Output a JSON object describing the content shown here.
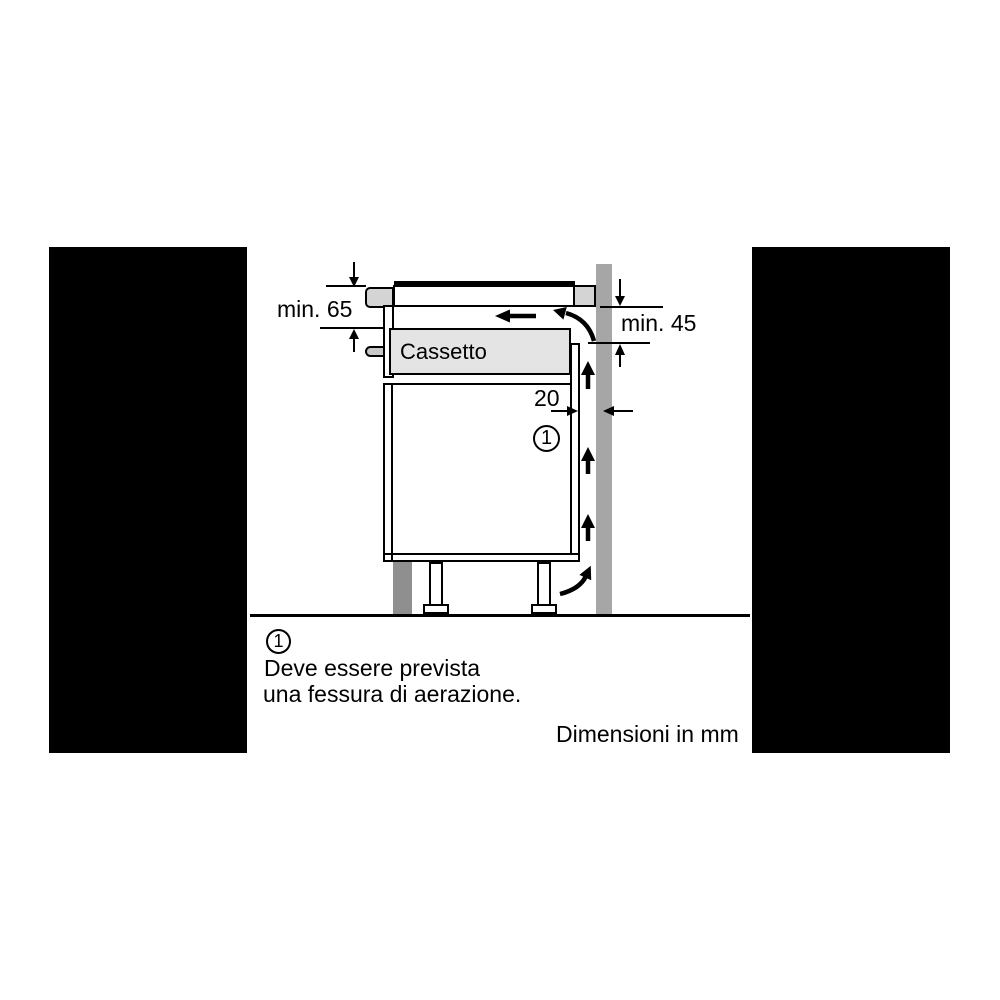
{
  "diagram": {
    "drawer_label": "Cassetto",
    "dimensions": {
      "worktop_depth": "min. 65",
      "wall_clearance": "min. 45",
      "rear_gap": "20"
    },
    "callout_marker": "1"
  },
  "footnote": {
    "marker": "1",
    "line1": "Deve essere prevista",
    "line2": "una fessura di aerazione."
  },
  "units_caption": "Dimensioni in mm",
  "icons": {
    "airflow_up_arrow": "↑",
    "airflow_left_arrow": "←",
    "airflow_curved_up_arrow": "⤴",
    "dimension_arrow": "▾"
  },
  "colors": {
    "line": "#000000",
    "mask": "#000000",
    "background": "#ffffff",
    "wall": "#a6a6a6",
    "plinth": "#8f8f8f",
    "worktop_edge": "#d4d4d4",
    "drawer_fill": "#e4e4e4",
    "fixing_pin": "#c8c8c8"
  }
}
